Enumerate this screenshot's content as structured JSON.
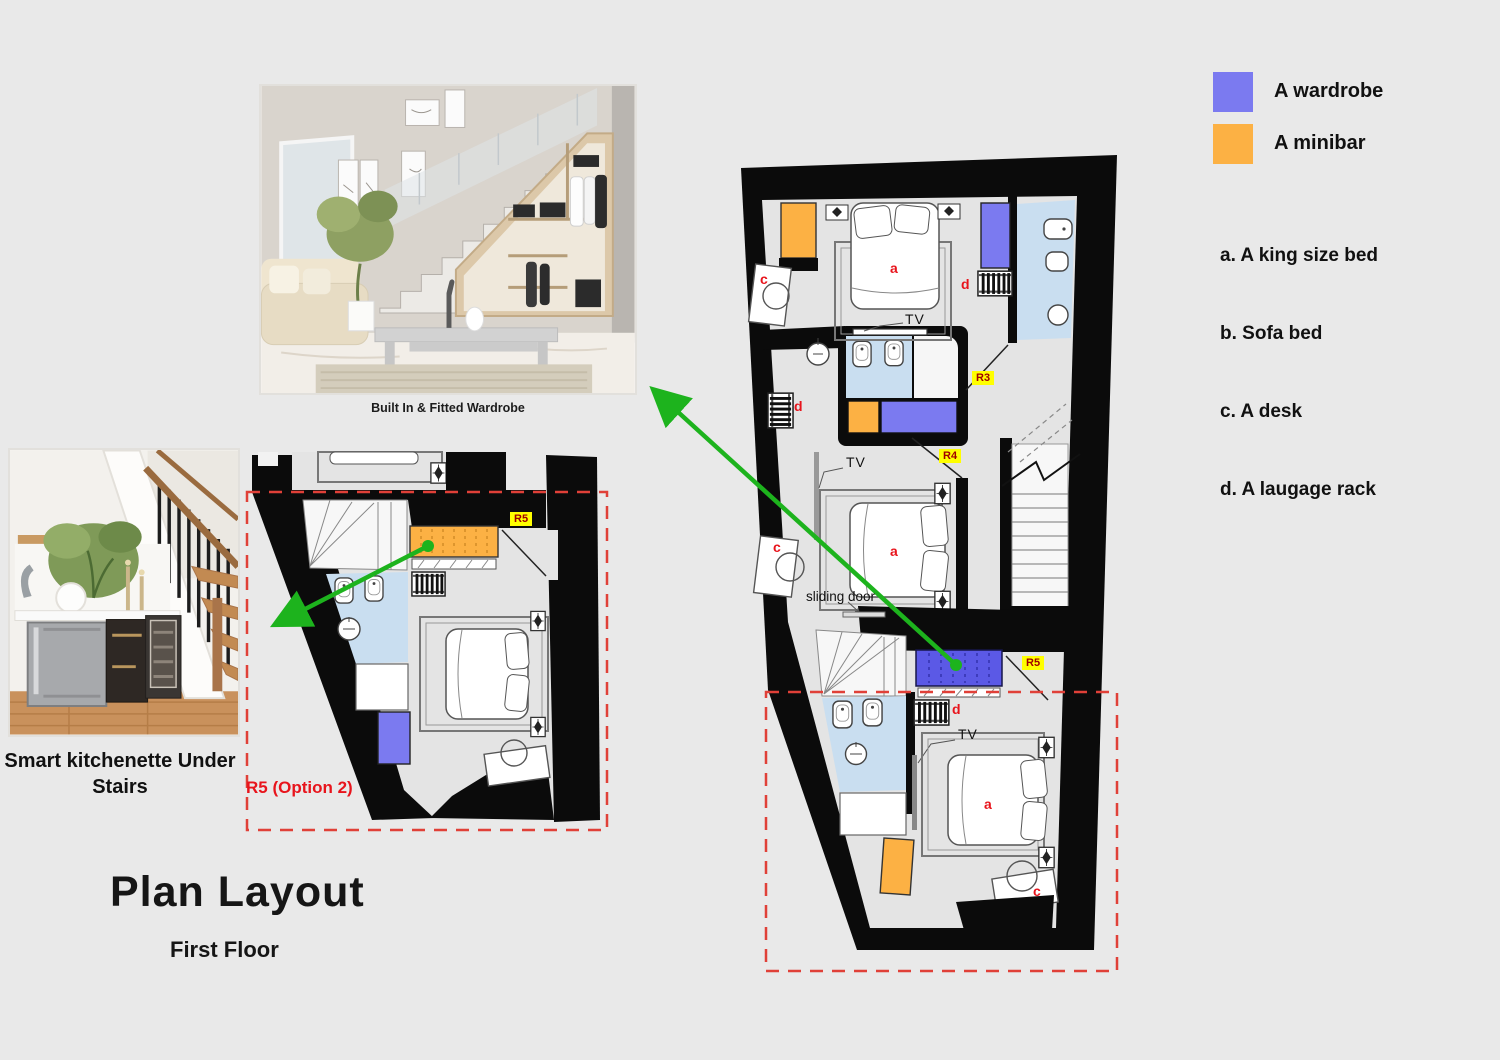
{
  "page": {
    "title": "Plan Layout",
    "subtitle": "First Floor",
    "background": "#e9e9e9"
  },
  "legend": {
    "wardrobe": {
      "label": "A wardrobe",
      "color": "#7b7af0"
    },
    "minibar": {
      "label": "A minibar",
      "color": "#fcb144"
    },
    "items": [
      {
        "text": "a. A king size bed"
      },
      {
        "text": "b. Sofa bed"
      },
      {
        "text": "c. A desk"
      },
      {
        "text": "d. A laugage rack"
      }
    ]
  },
  "photos": [
    {
      "caption": "Built In & Fitted Wardrobe"
    },
    {
      "caption": "Smart kitchenette Under Stairs"
    }
  ],
  "plan_labels": {
    "tv": "TV",
    "sliding_door": "sliding door",
    "r3": "R3",
    "r4": "R4",
    "r5": "R5",
    "r5_option2": "R5 (Option 2)",
    "a": "a",
    "c": "c",
    "d": "d"
  },
  "colors": {
    "wall": "#0b0b0b",
    "floor": "#e4e4e4",
    "wardrobe": "#7b7af0",
    "wardrobe_dark": "#5b59e6",
    "minibar": "#fcb144",
    "bathroom": "#c9def0",
    "arrow_green": "#1db31d",
    "dashed_red": "#e04038",
    "letter_red": "#e8141c",
    "tag_bg": "#ffff00"
  }
}
